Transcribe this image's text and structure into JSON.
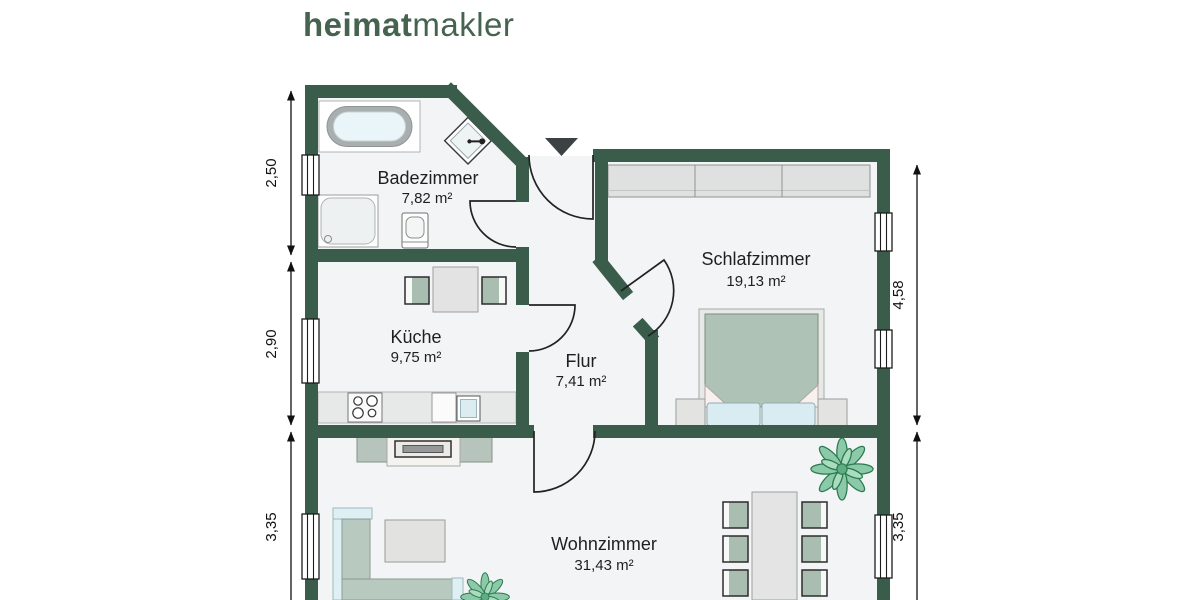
{
  "logo": {
    "bold": "heimat",
    "light": "makler"
  },
  "rooms": [
    {
      "id": "badezimmer",
      "name": "Badezimmer",
      "area": "7,82 m²"
    },
    {
      "id": "kueche",
      "name": "Küche",
      "area": "9,75 m²"
    },
    {
      "id": "flur",
      "name": "Flur",
      "area": "7,41 m²"
    },
    {
      "id": "schlafzimmer",
      "name": "Schlafzimmer",
      "area": "19,13 m²"
    },
    {
      "id": "wohnzimmer",
      "name": "Wohnzimmer",
      "area": "31,43 m²"
    }
  ],
  "dimensions": {
    "left": [
      "2,50",
      "2,90",
      "3,35"
    ],
    "right": [
      "4,58",
      "3,35"
    ]
  },
  "colors": {
    "wall_green": "#3a5c4b",
    "logo_green": "#45634f",
    "floor": "#f2f4f6",
    "furniture_green": "#a9bdb1",
    "soft_blue": "#d9ecf1"
  }
}
